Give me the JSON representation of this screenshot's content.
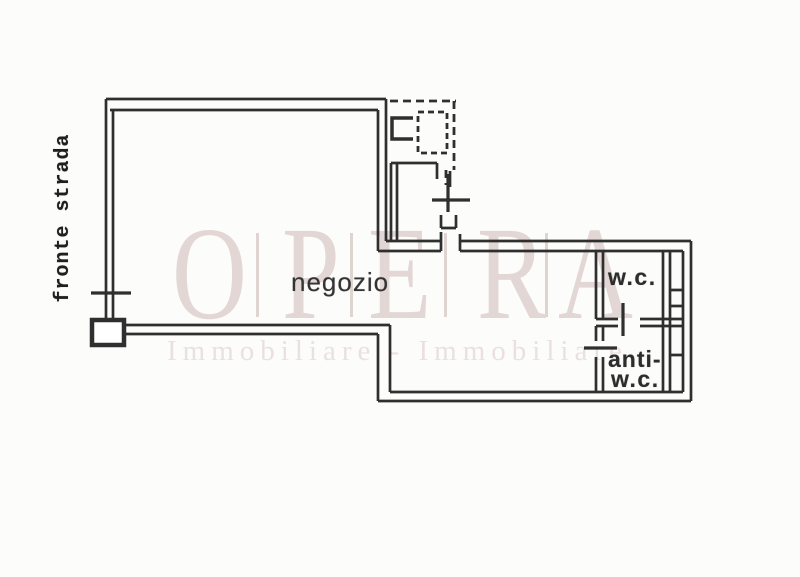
{
  "plan": {
    "labels": {
      "street_front": "fronte strada",
      "shop": "negozio",
      "wc": "w.c.",
      "anti_wc_top": "anti-",
      "anti_wc_bottom": "w.c."
    }
  },
  "watermark": {
    "letters": [
      "O",
      "P",
      "E",
      "R",
      "A"
    ],
    "subtitle": "Immobiliare - Immobiliare",
    "letters_color": "#e2d7d4",
    "subtitle_color": "#eae1de"
  },
  "colors": {
    "background": "#fcfcfb",
    "wall_line": "#2f2f2f",
    "label_text": "#2d2d2d"
  }
}
